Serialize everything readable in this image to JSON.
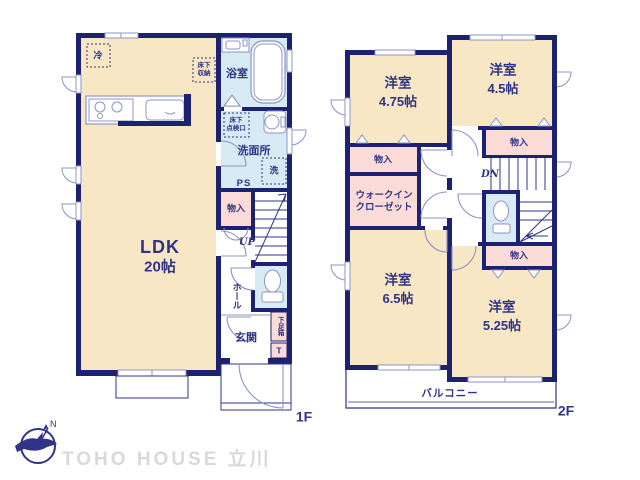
{
  "palette": {
    "wall": "#1c2170",
    "text": "#2f3486",
    "room_cream": "#f8e7c4",
    "wet_blue": "#d8eaf4",
    "closet_pink": "#fbdbd7",
    "fixture_line": "#8d94c4",
    "brand_gray": "#d9d9d9"
  },
  "brand": {
    "logo_text": "TOHO HOUSE 立川",
    "compass": "N"
  },
  "floor1": {
    "floor_label": "1F",
    "ldk_name": "LDK",
    "ldk_size": "20帖",
    "fridge": "冷",
    "underfloor_storage_1": "床下",
    "underfloor_storage_2": "収納",
    "bath": "浴室",
    "inspection_1": "床下",
    "inspection_2": "点検口",
    "washroom": "洗面所",
    "washer": "洗",
    "pipe_space": "PS",
    "closet": "物入",
    "stairs_up": "UP",
    "hall": "ホール",
    "entrance": "玄関",
    "shoe_cabinet": "下足箱",
    "shoe_cabinet_t": "T"
  },
  "floor2": {
    "floor_label": "2F",
    "room_nw_name": "洋室",
    "room_nw_size": "4.75帖",
    "room_ne_name": "洋室",
    "room_ne_size": "4.5帖",
    "room_sw_name": "洋室",
    "room_sw_size": "6.5帖",
    "room_se_name": "洋室",
    "room_se_size": "5.25帖",
    "closet_nw": "物入",
    "closet_ne": "物入",
    "closet_se": "物入",
    "wic_1": "ウォークイン",
    "wic_2": "クローゼット",
    "stairs_down": "DN",
    "balcony": "バルコニー"
  }
}
